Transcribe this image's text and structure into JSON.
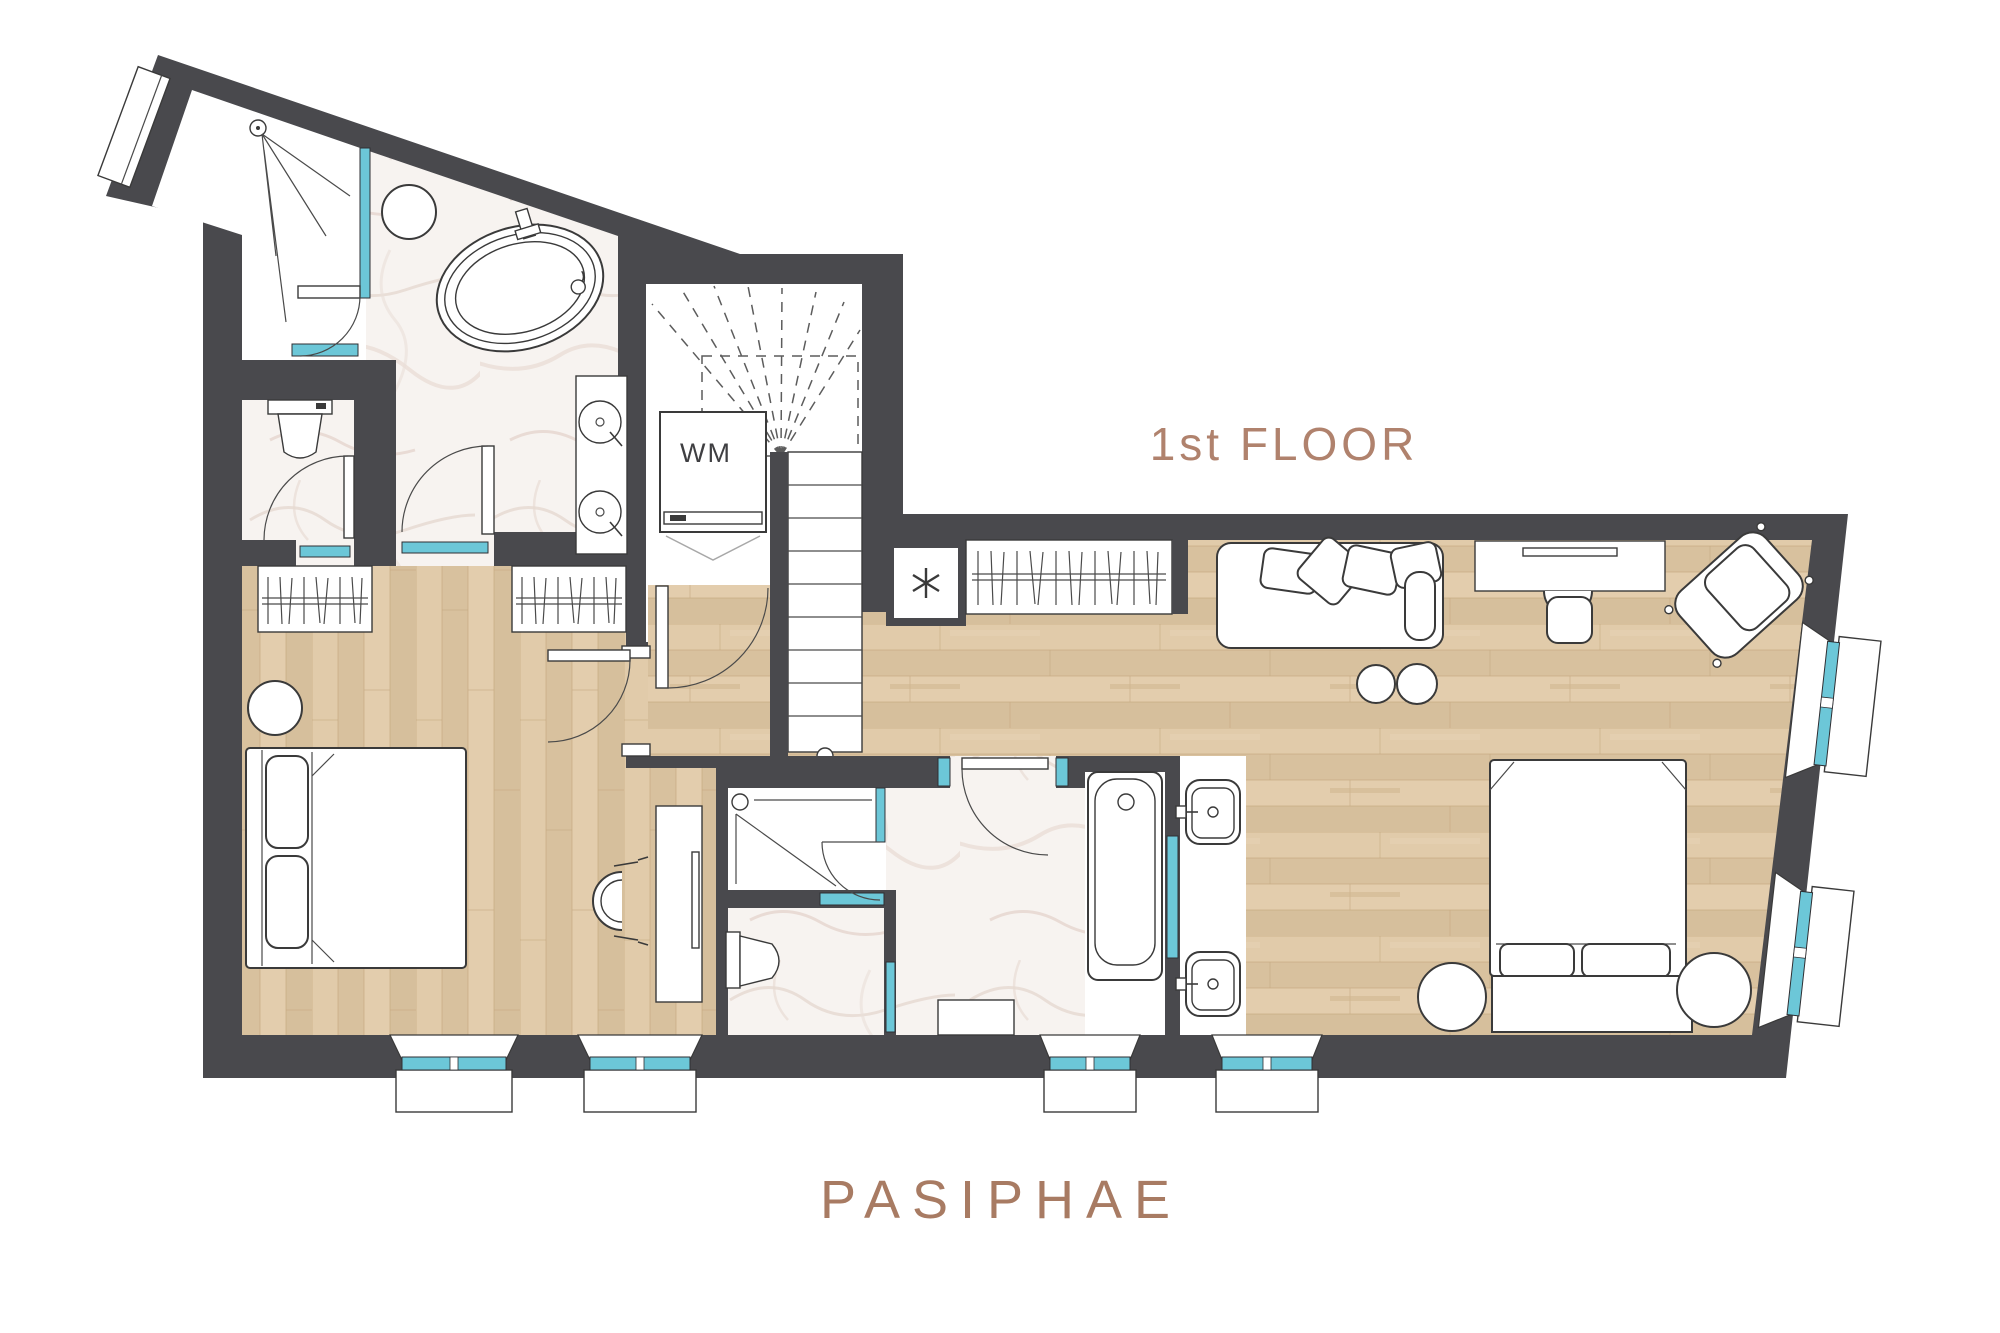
{
  "labels": {
    "floor_label": "1st FLOOR",
    "plan_title": "PASIPHAE",
    "washing_machine": "WM"
  },
  "icons": {
    "minibar_closet": "asterisk-snowflake-icon",
    "stair_up_flight": "dashed-fan",
    "window_glazing": "teal-bar"
  },
  "colors": {
    "wall": "#49494d",
    "wood_floor": "#ddc7a6",
    "marble_floor": "#f7f3f0",
    "glass_teal": "#6cc7d8",
    "floor_label_text": "#b0826d",
    "plan_title_text": "#a87b63",
    "furniture_stroke": "#3a3a3a",
    "background": "#ffffff"
  }
}
